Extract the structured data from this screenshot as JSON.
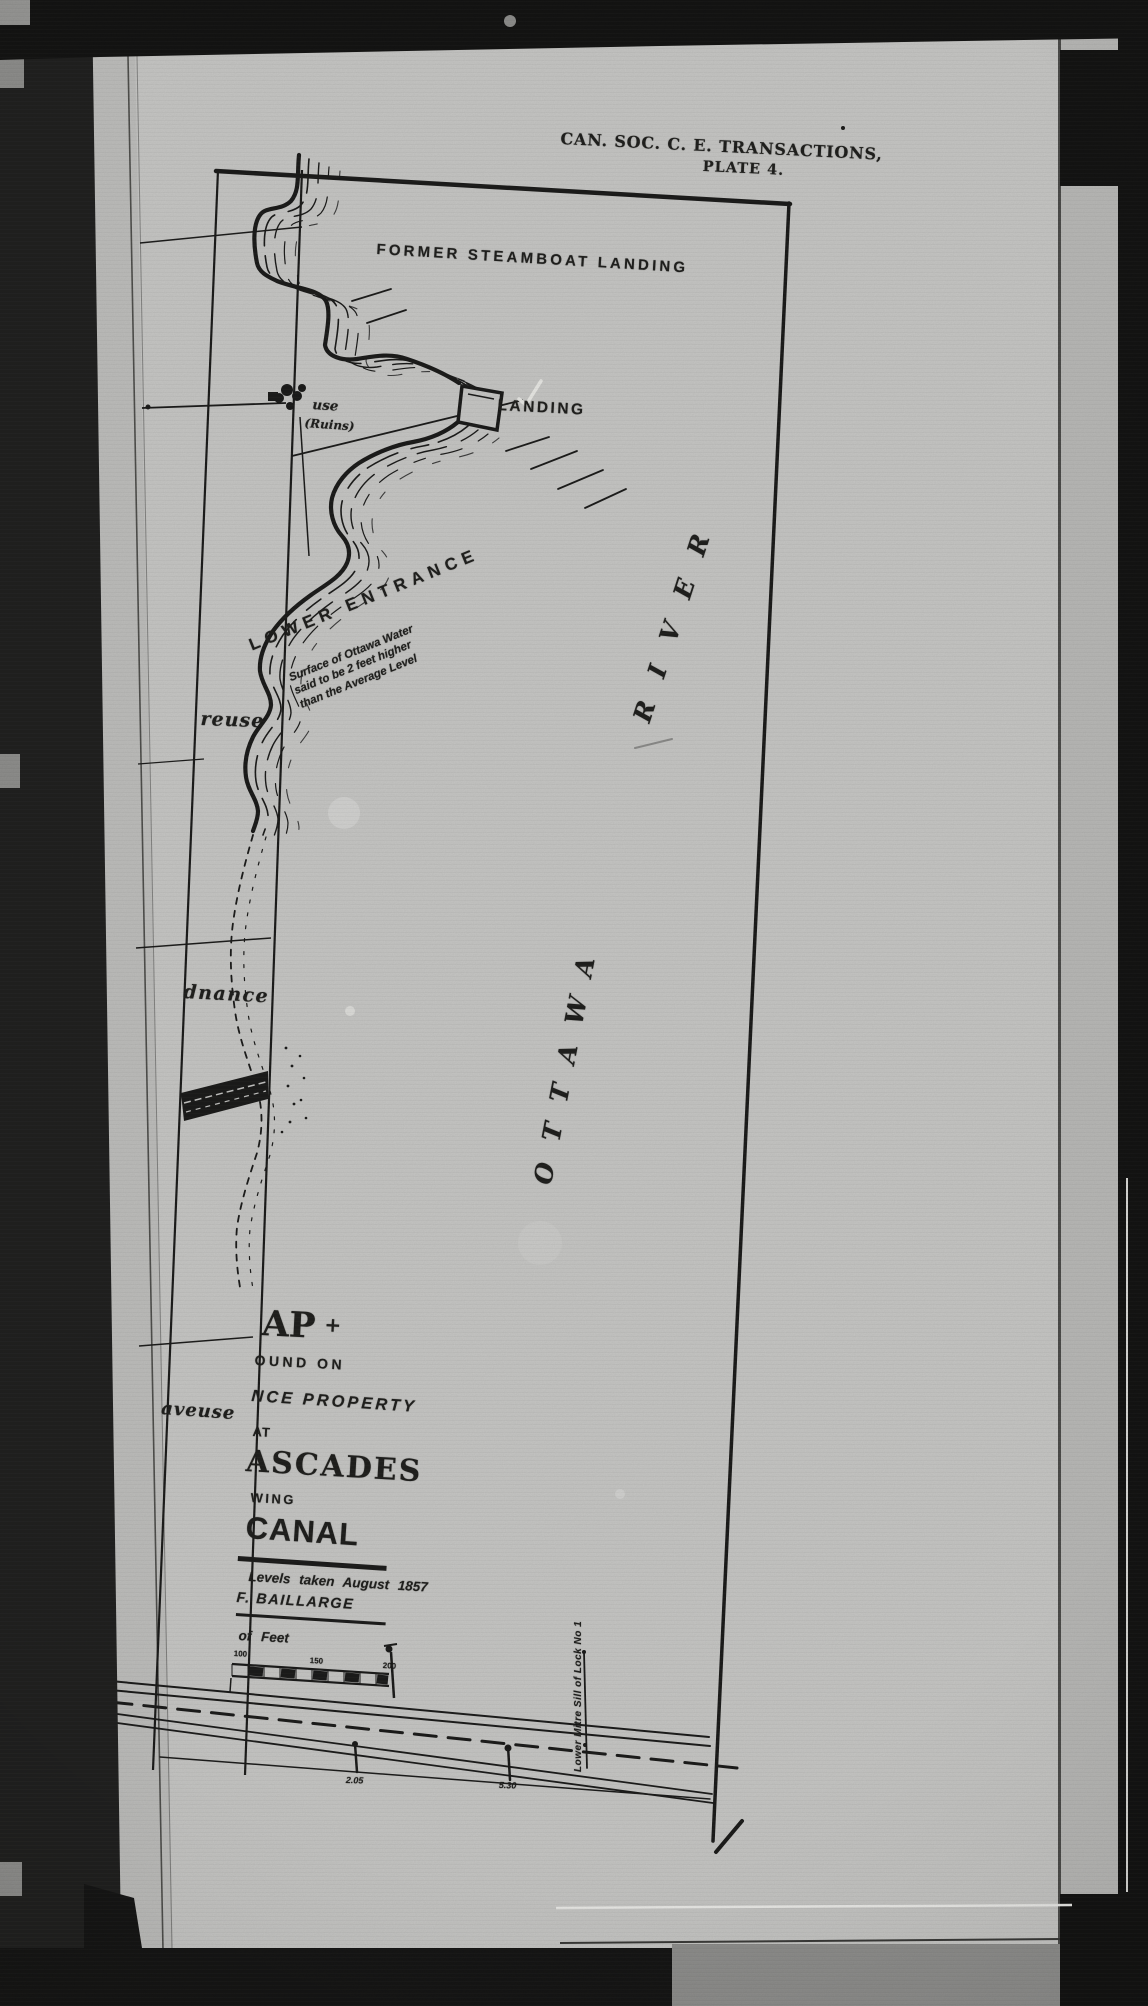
{
  "header": {
    "society_line": "CAN. SOC. C. E. TRANSACTIONS,",
    "plate_line": "PLATE 4."
  },
  "map": {
    "labels": {
      "former_steamboat_landing": "FORMER STEAMBOAT LANDING",
      "landing": "LANDING",
      "house_ruins_top": "use",
      "house_ruins_bottom": "(Ruins)",
      "lower_entrance": "LOWER ENTRANCE",
      "water_note_1": "Surface of Ottawa Water",
      "water_note_2": "said to be 2 feet higher",
      "water_note_3": "than the Average Level",
      "river_name_word1": "OTTAWA",
      "river_name_word2": "RIVER",
      "cutoff_text_1": "reuse",
      "cutoff_text_2": "dnance",
      "cutoff_text_3": "aveuse",
      "lock_sill_note": "Lower Mitre Sill of Lock No 1",
      "level_figure_1": "2.05",
      "level_figure_2": "5.30"
    },
    "title_block": {
      "map_word_cut": "AP",
      "map_word_symbol": "+",
      "line_found_on_cut": "OUND ON",
      "line_property_cut": "NCE PROPERTY",
      "line_at": "AT",
      "line_cascades_cut": "ASCADES",
      "line_showing_cut": "WING",
      "line_canal_cut": "CANAL",
      "survey_note_1": "Levels taken August 1857",
      "survey_note_2": "F. BAILLARGE",
      "scale_caption_cut": "of Feet",
      "scale_ticks": [
        "100",
        "150",
        "200"
      ]
    }
  }
}
